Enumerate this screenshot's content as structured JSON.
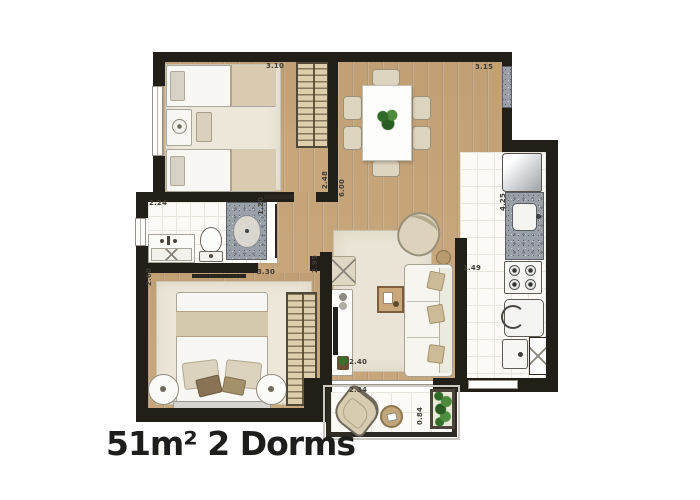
{
  "title": "51m² 2 Dorms",
  "dimensions": {
    "bedroom1_width": "3.10",
    "living_dining_width": "3.15",
    "bedroom1_depth": "2.48",
    "living_total_depth": "6.00",
    "bathroom_width": "2.24",
    "bathroom_depth": "1.20",
    "kitchen_depth": "4.25",
    "kitchen_width": "1.49",
    "bedroom2_depth": "2.60",
    "bedroom2_width": "3.30",
    "bedroom2_inner_depth": "2.95",
    "living_width": "2.40",
    "balcony_width": "2.34",
    "balcony_depth": "0.84"
  },
  "colors": {
    "wall": "#221e18",
    "wood_floor": "#c7a67c",
    "tile_floor": "#fbfaf6",
    "rug": "#ece7d9",
    "granite": "#9aa0a8",
    "wardrobe": "#ddcfac",
    "plant_green": "#3a7a2e",
    "label_text": "#413d36"
  }
}
